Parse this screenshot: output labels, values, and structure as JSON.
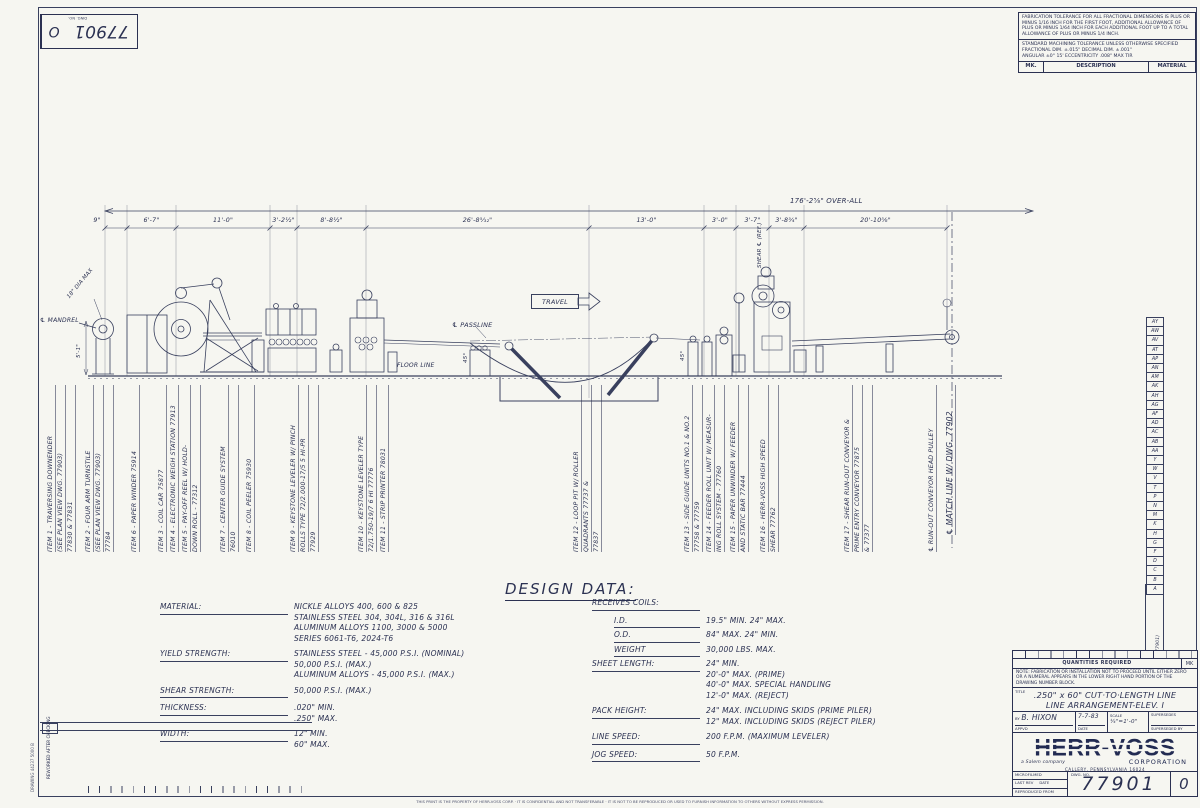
{
  "corner_block": {
    "dwg_no": "77901",
    "revision": "O",
    "dwg_no_label": "DWG. NO."
  },
  "tolerance_block": {
    "fabrication_note": "FABRICATION TOLERANCE FOR ALL FRACTIONAL DIMENSIONS IS PLUS OR MINUS 1/16 INCH FOR THE FIRST FOOT, ADDITIONAL ALLOWANCE OF PLUS OR MINUS 1/64 INCH FOR EACH ADDITIONAL FOOT UP TO A TOTAL ALLOWANCE OF PLUS OR MINUS 1/4 INCH.",
    "machining_line1": "STANDARD MACHINING TOLERANCE UNLESS OTHERWISE SPECIFIED",
    "machining_line2": "FRACTIONAL DIM. ±.015\"      DECIMAL DIM. ±.001\"",
    "machining_line3": "ANGULAR ±0° 15'      ECCENTRICITY .008\" MAX TIR",
    "parts_header": {
      "mk": "MK.",
      "description": "DESCRIPTION",
      "material": "MATERIAL"
    }
  },
  "dimensions": {
    "overall": "176'-2⅝\"  OVER-ALL",
    "segments": [
      {
        "text": "9\"",
        "x0": 84,
        "x1": 110
      },
      {
        "text": "6'-7\"",
        "x0": 127,
        "x1": 176
      },
      {
        "text": "11'-0\"",
        "x0": 176,
        "x1": 270
      },
      {
        "text": "3'-2½\"",
        "x0": 270,
        "x1": 297
      },
      {
        "text": "8'-8½\"",
        "x0": 297,
        "x1": 366
      },
      {
        "text": "26'-8⁵⁄₃₂\"",
        "x0": 366,
        "x1": 589
      },
      {
        "text": "13'-0\"",
        "x0": 589,
        "x1": 704
      },
      {
        "text": "3'-0\"",
        "x0": 704,
        "x1": 736
      },
      {
        "text": "3'-7\"",
        "x0": 736,
        "x1": 769
      },
      {
        "text": "3'-8¾\"",
        "x0": 769,
        "x1": 804
      },
      {
        "text": "20'-10⅝\"",
        "x0": 804,
        "x1": 947
      }
    ]
  },
  "drawing_labels": {
    "mandrel": "℄ MANDREL",
    "dia": "18\" DIA MAX",
    "height_dim": "5'-1\"",
    "travel": "TRAVEL",
    "passline": "℄ PASSLINE",
    "floor_line": "FLOOR LINE",
    "shear_cl": "SHEAR ℄ (REF.)",
    "angle_left": "45°",
    "angle_right": "45°"
  },
  "items": [
    {
      "x": 46,
      "lines": [
        "ITEM 1 - TRAVERSING DOWNENDER",
        "(SEE PLAN VIEW DWG. 77903)",
        "77830 & 77831"
      ]
    },
    {
      "x": 84,
      "lines": [
        "ITEM 2 - FOUR ARM TURNSTILE",
        "(SEE PLAN VIEW DWG. 77903)",
        "77784"
      ]
    },
    {
      "x": 130,
      "lines": [
        "ITEM 6 - PAPER WINDER 75914"
      ]
    },
    {
      "x": 157,
      "lines": [
        "ITEM 3 - COIL CAR 75877"
      ]
    },
    {
      "x": 169,
      "lines": [
        "ITEM 4 - ELECTRONIC WEIGH STATION 77913"
      ]
    },
    {
      "x": 181,
      "lines": [
        "ITEM 5 - PAY-OFF REEL W/ HOLD-",
        "DOWN ROLL - 77312"
      ]
    },
    {
      "x": 219,
      "lines": [
        "ITEM 7 - CENTER GUIDE SYSTEM",
        "76010"
      ]
    },
    {
      "x": 245,
      "lines": [
        "ITEM 8 - COIL PEELER 75930"
      ]
    },
    {
      "x": 289,
      "lines": [
        "ITEM 9 - KEYSTONE LEVELER W/ PINCH",
        "ROLLS TYPE 72/2.000-17/5  5 HI-PR",
        "77929"
      ]
    },
    {
      "x": 357,
      "lines": [
        "ITEM 10 - KEYSTONE LEVELER TYPE",
        "72/1.750-19/7  6 HI   77776"
      ]
    },
    {
      "x": 379,
      "lines": [
        "ITEM 11 - STRIP PRINTER  78031"
      ]
    },
    {
      "x": 572,
      "lines": [
        "ITEM 12 - LOOP PIT W/ ROLLER",
        "QUADRANTS 77737 &",
        "77837"
      ]
    },
    {
      "x": 683,
      "lines": [
        "ITEM 13 - SIDE GUIDE UNITS NO.1 & NO.2",
        "77758 & 77759"
      ]
    },
    {
      "x": 705,
      "lines": [
        "ITEM 14 - FEEDER ROLL UNIT W/ MEASUR-",
        "ING ROLL SYSTEM - 77760"
      ]
    },
    {
      "x": 729,
      "lines": [
        "ITEM 15 - PAPER UNWINDER W/ FEEDER",
        "AND STATIC BAR  77444"
      ]
    },
    {
      "x": 759,
      "lines": [
        "ITEM 16 - HERR-VOSS HIGH SPEED",
        "SHEAR   77762"
      ]
    },
    {
      "x": 843,
      "lines": [
        "ITEM 17 - SHEAR RUN-OUT CONVEYOR &",
        "PRIME ENTRY CONVEYOR  77875",
        "& 77377"
      ]
    },
    {
      "x": 927,
      "lines": [
        "℄ RUN-OUT CONVEYOR HEAD PULLEY"
      ]
    },
    {
      "x": 944,
      "b": 535,
      "big": true,
      "lines": [
        "℄ MATCH LINE W/ DWG. 77902"
      ]
    }
  ],
  "design_data": {
    "title": "DESIGN  DATA:",
    "left": [
      {
        "label": "MATERIAL:",
        "values": [
          "NICKLE ALLOYS 400, 600 & 825",
          "STAINLESS STEEL 304, 304L, 316 & 316L",
          "ALUMINUM ALLOYS 1100, 3000 & 5000",
          "SERIES 6061-T6, 2024-T6"
        ]
      },
      {
        "label": "YIELD STRENGTH:",
        "values": [
          "STAINLESS STEEL - 45,000 P.S.I. (NOMINAL)",
          "50,000 P.S.I. (MAX.)",
          "ALUMINUM ALLOYS - 45,000 P.S.I. (MAX.)"
        ]
      },
      {
        "label": "SHEAR STRENGTH:",
        "values": [
          "50,000 P.S.I. (MAX.)"
        ]
      },
      {
        "label": "THICKNESS:",
        "values": [
          ".020\" MIN.",
          ".250\" MAX."
        ]
      },
      {
        "label": "WIDTH:",
        "values": [
          "12\" MIN.",
          "60\" MAX."
        ]
      }
    ],
    "right": [
      {
        "label": "RECEIVES COILS:",
        "values": []
      },
      {
        "label": "I.D.",
        "sub": true,
        "values": [
          "19.5\" MIN.    24\" MAX."
        ]
      },
      {
        "label": "O.D.",
        "sub": true,
        "values": [
          "84\" MAX.    24\" MIN."
        ]
      },
      {
        "label": "WEIGHT",
        "sub": true,
        "values": [
          "30,000 LBS. MAX."
        ]
      },
      {
        "label": "SHEET LENGTH:",
        "values": [
          "24\" MIN.",
          "20'-0\" MAX. (PRIME)",
          "40'-0\" MAX. SPECIAL HANDLING",
          "12'-0\" MAX. (REJECT)"
        ]
      },
      {
        "label": "PACK HEIGHT:",
        "values": [
          "24\" MAX. INCLUDING SKIDS (PRIME PILER)",
          "12\" MAX. INCLUDING SKIDS (REJECT PILER)"
        ]
      },
      {
        "label": "LINE SPEED:",
        "values": [
          "200 F.P.M. (MAXIMUM LEVELER)"
        ]
      },
      {
        "label": "JOG SPEED:",
        "values": [
          "50 F.P.M."
        ]
      }
    ]
  },
  "revision_strip": [
    "AY",
    "AW",
    "AV",
    "AT",
    "AP",
    "AN",
    "AM",
    "AK",
    "AH",
    "AG",
    "AF",
    "AD",
    "AC",
    "AB",
    "AA",
    "Y",
    "W",
    "V",
    "T",
    "P",
    "N",
    "M",
    "K",
    "H",
    "G",
    "F",
    "D",
    "C",
    "B",
    "A"
  ],
  "title_block": {
    "quantities_label": "QUANTITIES REQUIRED",
    "mk_label": "MK",
    "note": "NOTE:  FABRICATION OR INSTALLATION NOT TO PROCEED UNTIL EITHER ZERO OR A NUMERAL APPEARS IN THE LOWER RIGHT HAND PORTION OF THE DRAWING NUMBER BLOCK.",
    "title_label": "TITLE",
    "title_line1": ".250\" x 60\" CUT·TO·LENGTH LINE",
    "title_line2": "LINE ARRANGEMENT-ELEV. I",
    "by_label": "BY",
    "drawn_by": "B. HIXON",
    "appvd_label": "APPVD",
    "date": "7-7-83",
    "date_label": "DATE",
    "scale_label": "SCALE",
    "scale": "¼\"=1'-0\"",
    "supersedes_label": "SUPERSEDES",
    "superseded_by_label": "SUPERSEDED BY",
    "company": "HERR-VOSS",
    "corporation": "CORPORATION",
    "salem": "a Salem company",
    "address": "CALLERY, PENNSYLVANIA 16024",
    "microfilmed": "MICROFILMED",
    "last_rev": "LAST REV",
    "reproduced": "REPRODUCED FROM",
    "dwg_no_label": "DWG. NO.",
    "dwg_no": "77901",
    "revision": "0"
  },
  "margin": {
    "reworked": "REWORKED AFTER CHECKING",
    "form_no": "DRAWING 44237 5000 B",
    "side_code": "(77901)",
    "fine_print": "THIS PRINT IS THE PROPERTY OF HERR-VOSS CORP. · IT IS CONFIDENTIAL AND NOT TRANSFERABLE · IT IS NOT TO BE REPRODUCED OR USED TO FURNISH INFORMATION TO OTHERS WITHOUT EXPRESS PERMISSION."
  }
}
